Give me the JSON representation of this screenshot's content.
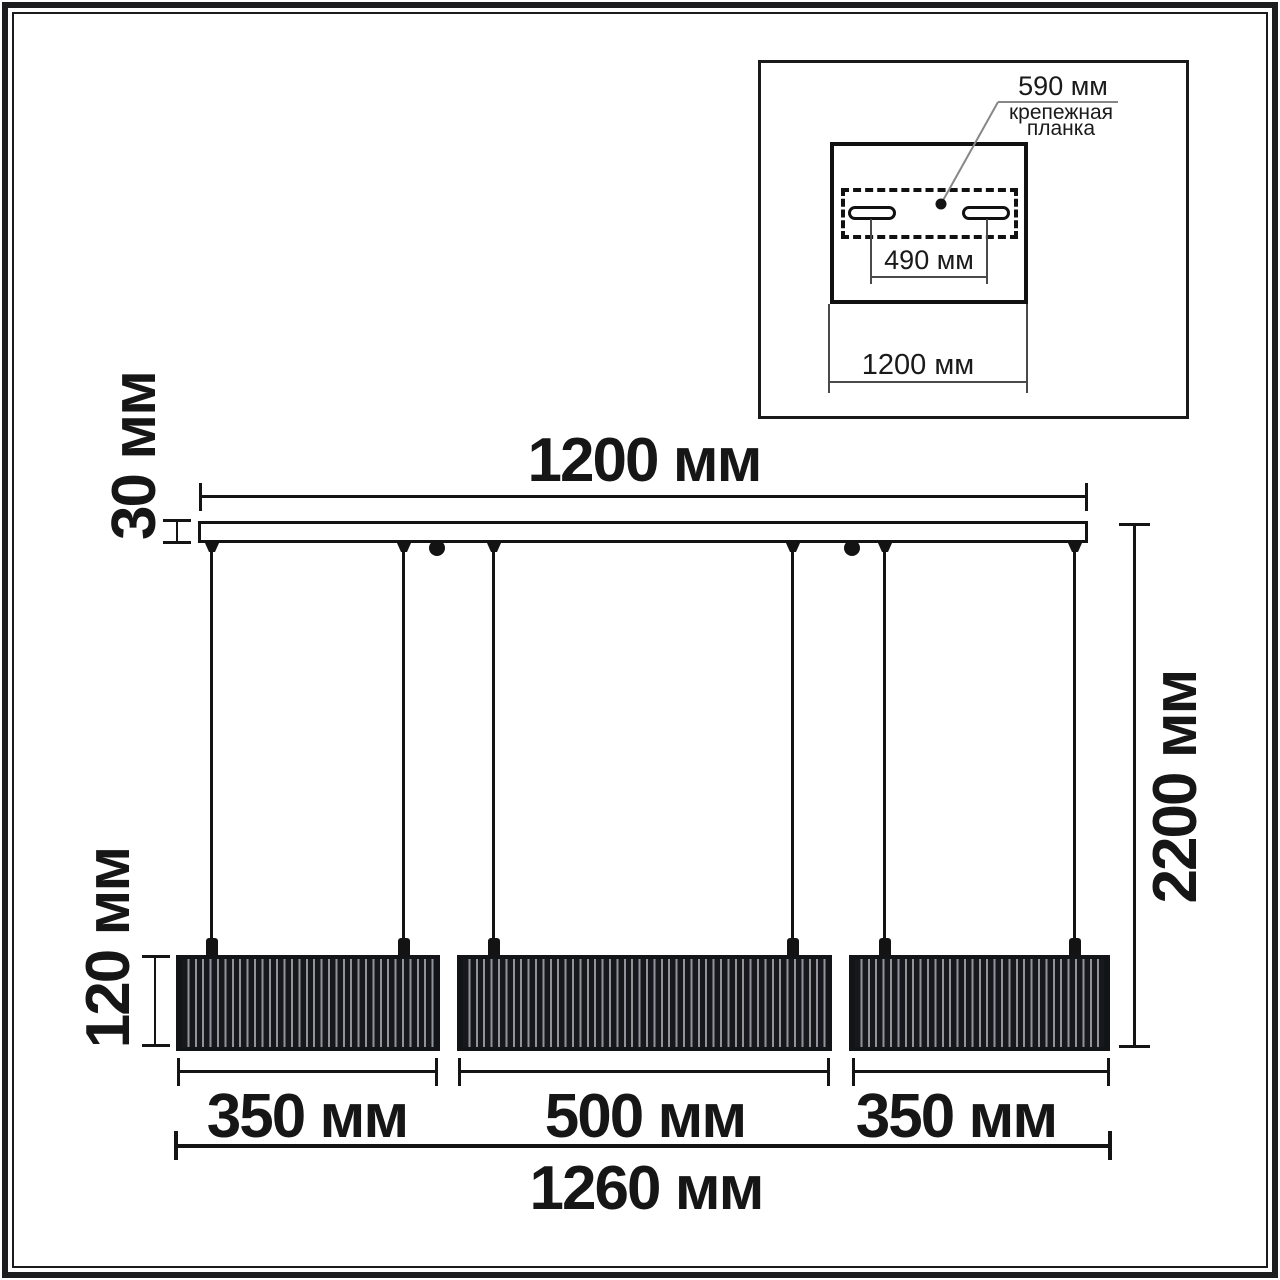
{
  "colors": {
    "ink": "#141414",
    "shade_dark": "#17181c",
    "shade_stripe": "#8f939b",
    "leader_gray": "#878787",
    "background": "#ffffff"
  },
  "main_drawing": {
    "bar_width_label": "1200 мм",
    "bar_height_label": "30 мм",
    "total_height_label": "2200 мм",
    "shade_height_label": "120 мм",
    "shade_left_width_label": "350 мм",
    "shade_center_width_label": "500 мм",
    "shade_right_width_label": "350 мм",
    "total_width_label": "1260 мм"
  },
  "inset": {
    "plate_length_label": "590 мм",
    "plate_name": "крепежная\nпланка",
    "hole_spacing_label": "490 мм",
    "canopy_width_label": "1200 мм"
  }
}
